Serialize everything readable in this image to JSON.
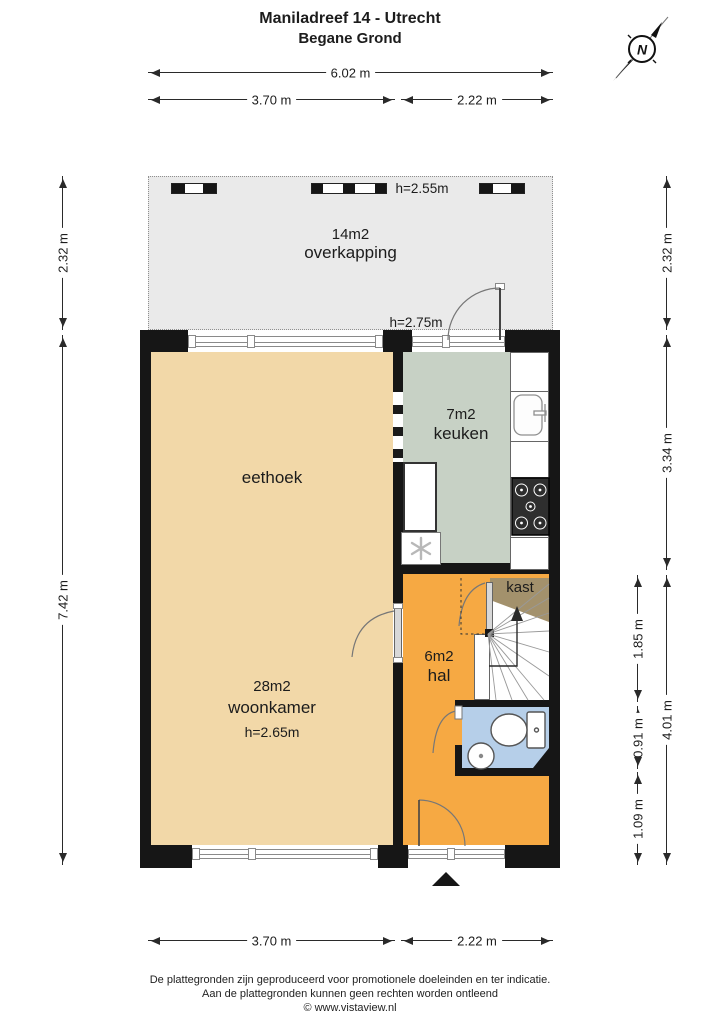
{
  "page": {
    "title_line1": "Maniladreef 14 - Utrecht",
    "title_line2": "Begane Grond"
  },
  "compass": {
    "label": "N"
  },
  "dims": {
    "top_total": "6.02 m",
    "top_left": "3.70 m",
    "top_right": "2.22 m",
    "left_upper": "2.32 m",
    "left_lower": "7.42 m",
    "right_upper": "2.32 m",
    "right_kitchen": "3.34 m",
    "right_lower": "4.01 m",
    "right_inner_top": "1.85 m",
    "right_inner_mid": "0.91 m",
    "right_inner_bottom": "1.09 m",
    "bottom_left": "3.70 m",
    "bottom_right": "2.22 m"
  },
  "rooms": {
    "overkapping": {
      "area": "14m2",
      "name": "overkapping",
      "ceiling": "h=2.55m"
    },
    "keuken_door_ceiling": "h=2.75m",
    "eethoek": {
      "name": "eethoek"
    },
    "woonkamer": {
      "area": "28m2",
      "name": "woonkamer",
      "ceiling": "h=2.65m"
    },
    "keuken": {
      "area": "7m2",
      "name": "keuken"
    },
    "hal": {
      "area": "6m2",
      "name": "hal"
    },
    "kast": {
      "name": "kast"
    }
  },
  "colors": {
    "overkapping": "#eaeaea",
    "woonkamer": "#f2d8a8",
    "keuken": "#c7d1c5",
    "hal": "#f6a943",
    "kast": "#a3916c",
    "toilet": "#b6cfe9"
  },
  "footer": {
    "line1": "De plattegronden zijn geproduceerd voor promotionele doeleinden en ter indicatie.",
    "line2": "Aan de plattegronden kunnen geen rechten worden ontleend",
    "line3": "© www.vistaview.nl"
  }
}
